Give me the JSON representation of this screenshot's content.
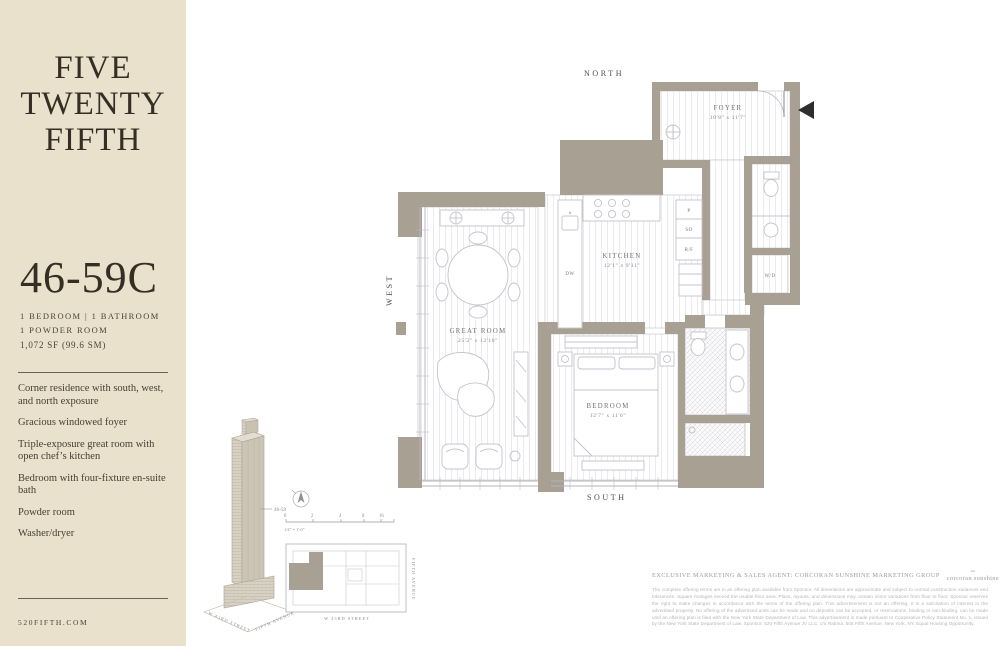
{
  "sidebar": {
    "logo": [
      "FIVE",
      "TWENTY",
      "FIFTH"
    ],
    "unit": "46-59C",
    "specs1": "1 BEDROOM | 1 BATHROOM",
    "specs2": "1 POWDER ROOM",
    "area": "1,072 SF (99.6 SM)",
    "features": [
      "Corner residence with south, west, and north exposure",
      "Gracious windowed foyer",
      "Triple-exposure great room with open chef’s kitchen",
      "Bedroom with four-fixture en-suite bath",
      "Powder room",
      "Washer/dryer"
    ],
    "website": "520FIFTH.COM"
  },
  "locator": {
    "callout": "46-59",
    "tower_street_left": "W 43RD STREET",
    "tower_street_right": "FIFTH AVENUE",
    "scale": [
      "0",
      "2",
      "4",
      "8",
      "16"
    ],
    "scale_label": "1/4\" = 1'-0\"",
    "plan_street_bottom": "W 43RD STREET",
    "plan_street_right": "FIFTH AVENUE"
  },
  "plan": {
    "north": "NORTH",
    "south": "SOUTH",
    "west": "WEST",
    "rooms": {
      "foyer": {
        "name": "FOYER",
        "dims": "10'8\" x 11'7\""
      },
      "kitchen": {
        "name": "KITCHEN",
        "dims": "12'1\" x 9'11\""
      },
      "great_room": {
        "name": "GREAT ROOM",
        "dims": "25'2\" x 12'10\""
      },
      "bedroom": {
        "name": "BEDROOM",
        "dims": "12'7\" x 11'6\""
      }
    },
    "appl": {
      "dw": "DW",
      "p": "P",
      "so": "SO",
      "rf": "R/F",
      "wd": "W/D"
    }
  },
  "footer": {
    "agent": "EXCLUSIVE MARKETING & SALES AGENT: CORCORAN SUNSHINE MARKETING GROUP",
    "corcoran": "corcoran sunshine",
    "corcoran_sub": "marketing group",
    "rabina": "RABINA",
    "eh": "⌂",
    "disclaimer": "The complete offering terms are in an offering plan available from Sponsor. All dimensions are approximate and subject to normal construction variances and tolerances. Square footages exceed the usable floor area. Plans, layouts, and dimensions may contain minor variations from floor to floor. Sponsor reserves the right to make changes in accordance with the terms of the offering plan. This advertisement is not an offering. It is a solicitation of interest in the advertised property. No offering of the advertised units can be made and no deposits can be accepted, or reservations, binding or non-binding, can be made until an offering plan is filed with the New York State Department of Law. This advertisement is made pursuant to Cooperative Policy Statement No. 1, issued by the New York State Department of Law. Sponsor: 520 Fifth Avenue JV LLC, c/o Rabina, 505 Fifth Avenue, New York, NY. Equal Housing Opportunity."
  }
}
